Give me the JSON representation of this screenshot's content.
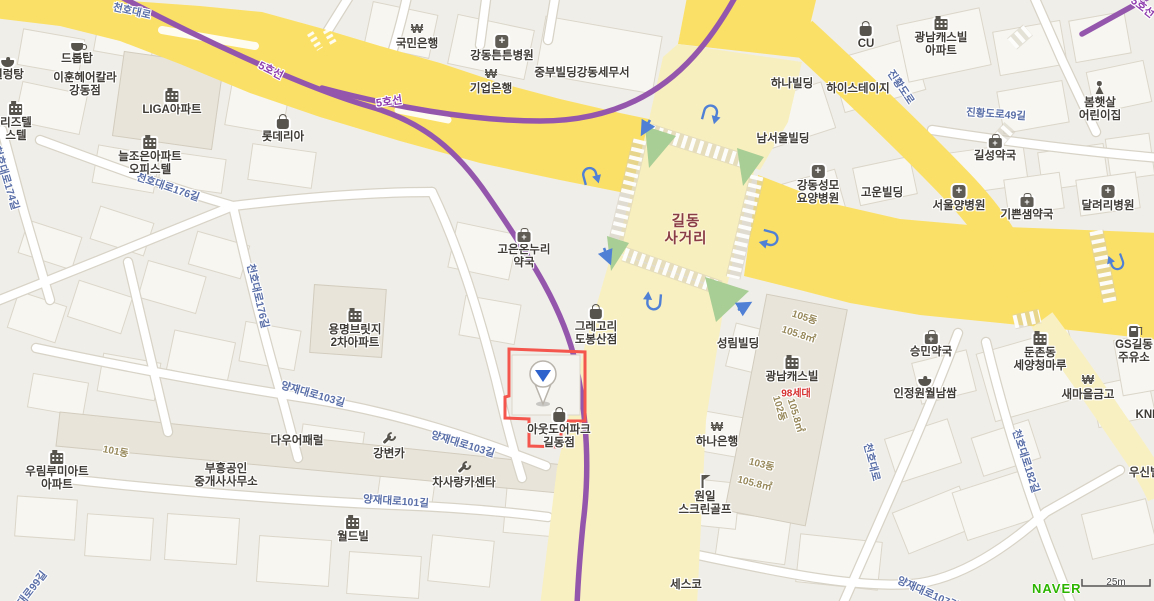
{
  "map": {
    "intersection": {
      "lines": [
        "길동",
        "사거리"
      ],
      "x": 686,
      "y": 214
    },
    "attribution": {
      "logo": "NAVER",
      "scale_text": "25m"
    },
    "colors": {
      "road_yellow": "#FBE067",
      "road_pale": "#F8F0C0",
      "subway_purple": "#9456AD",
      "road_label_blue": "#5A6FA8",
      "poi_text": "#3F3B36",
      "note_olive": "#97885A",
      "note_red": "#D63030",
      "intersection_text": "#8A3C46",
      "arrow_blue": "#4F80D6",
      "island_green": "#A8CD95",
      "marker_blue": "#2D62CC",
      "highlight_red": "#F4554D",
      "naver_green": "#2DB400"
    },
    "subway_labels": [
      {
        "text": "5호선",
        "x": 271,
        "y": 70,
        "rot": 27
      },
      {
        "text": "5호선",
        "x": 389,
        "y": 101,
        "rot": -8
      },
      {
        "text": "5호선",
        "x": 1143,
        "y": 7,
        "rot": 38
      }
    ],
    "road_labels": [
      {
        "text": "천호대로",
        "x": 132,
        "y": 11,
        "rot": 13
      },
      {
        "text": "천호대로176길",
        "x": 168,
        "y": 187,
        "rot": 19
      },
      {
        "text": "천호대로176길",
        "x": 258,
        "y": 296,
        "rot": 77
      },
      {
        "text": "천호대로174길",
        "x": 6,
        "y": 178,
        "rot": 73
      },
      {
        "text": "양재대로103길",
        "x": 313,
        "y": 394,
        "rot": 16
      },
      {
        "text": "양재대로103길",
        "x": 463,
        "y": 444,
        "rot": 17
      },
      {
        "text": "양재대로101길",
        "x": 396,
        "y": 501,
        "rot": 4
      },
      {
        "text": "양재대로99길",
        "x": 26,
        "y": 596,
        "rot": -52
      },
      {
        "text": "양재대로107길",
        "x": 928,
        "y": 593,
        "rot": 24
      },
      {
        "text": "천호대로",
        "x": 872,
        "y": 462,
        "rot": 76
      },
      {
        "text": "천호대로182길",
        "x": 1026,
        "y": 461,
        "rot": 72
      },
      {
        "text": "진황도로",
        "x": 901,
        "y": 87,
        "rot": 56
      },
      {
        "text": "진황도로49길",
        "x": 996,
        "y": 114,
        "rot": 4
      }
    ],
    "building_notes": [
      {
        "text": "101동",
        "x": 116,
        "y": 450,
        "rot": 11,
        "c": "olive"
      },
      {
        "text": "105동",
        "x": 805,
        "y": 316,
        "rot": 18,
        "c": "olive"
      },
      {
        "text": "105.8㎡",
        "x": 799,
        "y": 333,
        "rot": 18,
        "c": "olive"
      },
      {
        "text": "102동",
        "x": 781,
        "y": 408,
        "rot": 73,
        "c": "olive"
      },
      {
        "text": "105.8㎡",
        "x": 797,
        "y": 415,
        "rot": 73,
        "c": "olive"
      },
      {
        "text": "103동",
        "x": 762,
        "y": 463,
        "rot": 14,
        "c": "olive"
      },
      {
        "text": "105.8㎡",
        "x": 755,
        "y": 482,
        "rot": 14,
        "c": "olive"
      },
      {
        "text": "98세대",
        "x": 796,
        "y": 392,
        "rot": 0,
        "c": "red"
      }
    ],
    "pois": [
      {
        "lines": [
          "드롭탑"
        ],
        "icon": "cafe",
        "x": 77,
        "y": 38
      },
      {
        "lines": [
          "설렁탕"
        ],
        "icon": "restaurant",
        "x": 8,
        "y": 54
      },
      {
        "lines": [
          "이훈헤어칼라",
          "강동점"
        ],
        "x": 85,
        "y": 72
      },
      {
        "lines": [
          "LIGA아파트"
        ],
        "icon": "building",
        "x": 172,
        "y": 88
      },
      {
        "lines": [
          "롯데리아"
        ],
        "icon": "shop",
        "x": 283,
        "y": 115
      },
      {
        "lines": [
          "늘조은아파트",
          "오피스텔"
        ],
        "icon": "building",
        "x": 150,
        "y": 135
      },
      {
        "lines": [
          "리즈텔",
          "스텔"
        ],
        "icon": "building",
        "x": 16,
        "y": 101
      },
      {
        "lines": [
          "국민은행"
        ],
        "icon": "bank",
        "x": 417,
        "y": 22
      },
      {
        "lines": [
          "강동튼튼병원"
        ],
        "icon": "hospital",
        "x": 502,
        "y": 35
      },
      {
        "lines": [
          "기업은행"
        ],
        "icon": "bank",
        "x": 491,
        "y": 67
      },
      {
        "lines": [
          "중부빌딩강동세무서"
        ],
        "x": 582,
        "y": 67
      },
      {
        "lines": [
          "CU"
        ],
        "icon": "shop",
        "x": 866,
        "y": 22
      },
      {
        "lines": [
          "광남캐스빌",
          "아파트"
        ],
        "icon": "building",
        "x": 941,
        "y": 16
      },
      {
        "lines": [
          "하나빌딩"
        ],
        "x": 792,
        "y": 78
      },
      {
        "lines": [
          "하이스테이지"
        ],
        "x": 858,
        "y": 83
      },
      {
        "lines": [
          "봄햇살",
          "어린이집"
        ],
        "icon": "person",
        "x": 1100,
        "y": 81
      },
      {
        "lines": [
          "남서울빌딩"
        ],
        "x": 783,
        "y": 133
      },
      {
        "lines": [
          "강동성모",
          "요양병원"
        ],
        "icon": "hospital",
        "x": 818,
        "y": 165
      },
      {
        "lines": [
          "고운빌딩"
        ],
        "x": 882,
        "y": 187
      },
      {
        "lines": [
          "길성약국"
        ],
        "icon": "pharmacy",
        "x": 995,
        "y": 134
      },
      {
        "lines": [
          "서울양병원"
        ],
        "icon": "hospital",
        "x": 959,
        "y": 185
      },
      {
        "lines": [
          "기쁜샘약국"
        ],
        "icon": "pharmacy",
        "x": 1027,
        "y": 193
      },
      {
        "lines": [
          "달려리병원"
        ],
        "icon": "hospital",
        "x": 1108,
        "y": 185
      },
      {
        "lines": [
          "고은온누리",
          "약국"
        ],
        "icon": "pharmacy",
        "x": 524,
        "y": 228
      },
      {
        "lines": [
          "그레고리",
          "도봉산점"
        ],
        "icon": "shop",
        "x": 596,
        "y": 305
      },
      {
        "lines": [
          "아웃도어파크",
          "길동점"
        ],
        "icon": "shop",
        "x": 559,
        "y": 408
      },
      {
        "lines": [
          "성림빌딩"
        ],
        "x": 738,
        "y": 338
      },
      {
        "lines": [
          "광남캐스빌"
        ],
        "icon": "building",
        "x": 792,
        "y": 355
      },
      {
        "lines": [
          "하나은행"
        ],
        "icon": "bank",
        "x": 717,
        "y": 420
      },
      {
        "lines": [
          "원일",
          "스크린골프"
        ],
        "icon": "golf",
        "x": 705,
        "y": 475
      },
      {
        "lines": [
          "승민약국"
        ],
        "icon": "pharmacy",
        "x": 931,
        "y": 330
      },
      {
        "lines": [
          "인정원월남쌈"
        ],
        "icon": "restaurant",
        "x": 925,
        "y": 373
      },
      {
        "lines": [
          "둔촌동",
          "세양청마루"
        ],
        "icon": "building",
        "x": 1040,
        "y": 331
      },
      {
        "lines": [
          "새마을금고"
        ],
        "icon": "bank",
        "x": 1088,
        "y": 373
      },
      {
        "lines": [
          "GS길동",
          "주유소"
        ],
        "icon": "fuel",
        "x": 1134,
        "y": 323
      },
      {
        "lines": [
          "KNB"
        ],
        "x": 1148,
        "y": 409
      },
      {
        "lines": [
          "우신빌딩"
        ],
        "x": 1150,
        "y": 467
      },
      {
        "lines": [
          "세스코"
        ],
        "x": 686,
        "y": 579
      },
      {
        "lines": [
          "월드빌"
        ],
        "icon": "building",
        "x": 353,
        "y": 515
      },
      {
        "lines": [
          "다우어패럴"
        ],
        "x": 297,
        "y": 435
      },
      {
        "lines": [
          "부흥공인",
          "중개사사무소"
        ],
        "x": 226,
        "y": 463
      },
      {
        "lines": [
          "우림루미아트",
          "아파트"
        ],
        "icon": "building",
        "x": 57,
        "y": 450
      },
      {
        "lines": [
          "강변카"
        ],
        "icon": "wrench",
        "x": 389,
        "y": 432
      },
      {
        "lines": [
          "차사랑카센타"
        ],
        "icon": "wrench",
        "x": 464,
        "y": 461
      },
      {
        "lines": [
          "용명브릿지",
          "2차아파트"
        ],
        "icon": "building",
        "x": 355,
        "y": 308
      }
    ]
  }
}
